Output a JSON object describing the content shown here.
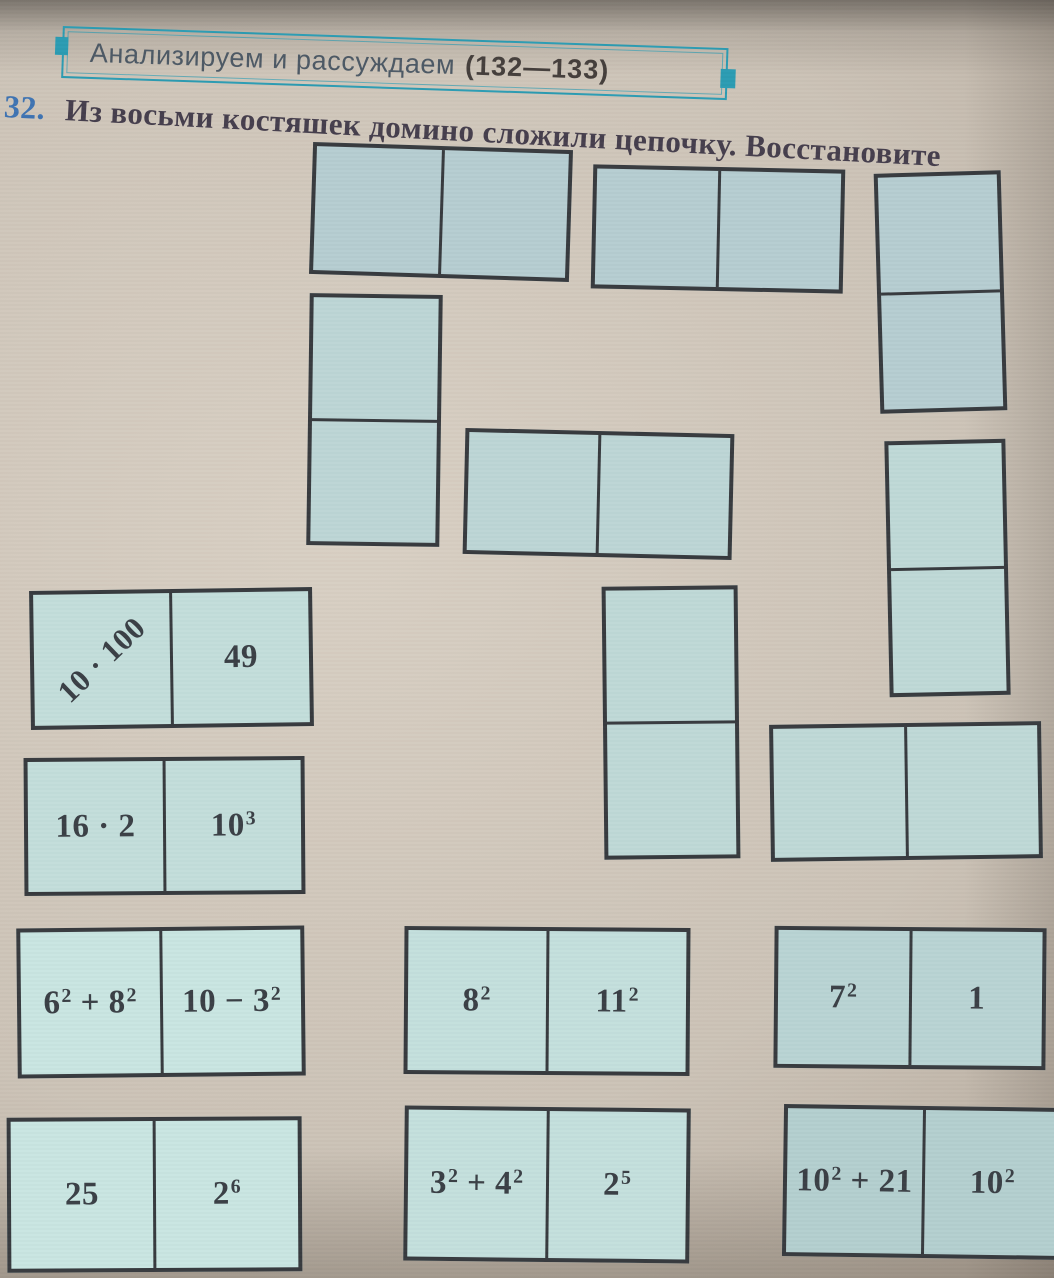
{
  "header": {
    "banner_text": "Анализируем и рассуждаем",
    "banner_pages": "(132—133)"
  },
  "task": {
    "number": "32.",
    "text": "Из восьми костяшек домино сложили цепочку. Восстановите"
  },
  "colors": {
    "banner_teal": "#2c9cb3",
    "task_number_blue": "#3f74b3",
    "domino_fill": "#c0dad8",
    "domino_border": "#383b3f",
    "math_text": "#3b4046"
  },
  "empty_dominoes": [
    {
      "id": "e1",
      "orientation": "horizontal"
    },
    {
      "id": "e2",
      "orientation": "horizontal"
    },
    {
      "id": "e3",
      "orientation": "vertical"
    },
    {
      "id": "e4",
      "orientation": "vertical"
    },
    {
      "id": "e5",
      "orientation": "horizontal"
    },
    {
      "id": "e6",
      "orientation": "vertical"
    },
    {
      "id": "e7",
      "orientation": "vertical"
    },
    {
      "id": "e8",
      "orientation": "horizontal"
    }
  ],
  "filled_dominoes": [
    {
      "id": "f1",
      "left": "10 · 100",
      "right": "49",
      "left_diagonal": true
    },
    {
      "id": "f2",
      "left": "16 · 2",
      "right": "10^3"
    },
    {
      "id": "f3",
      "left": "6^2 + 8^2",
      "right": "10 − 3^2"
    },
    {
      "id": "f4",
      "left": "25",
      "right": "2^6"
    },
    {
      "id": "f5",
      "left": "8^2",
      "right": "11^2"
    },
    {
      "id": "f6",
      "left": "3^2 + 4^2",
      "right": "2^5"
    },
    {
      "id": "f7",
      "left": "7^2",
      "right": "1"
    },
    {
      "id": "f8",
      "left": "10^2 + 21",
      "right": "10^2"
    }
  ]
}
